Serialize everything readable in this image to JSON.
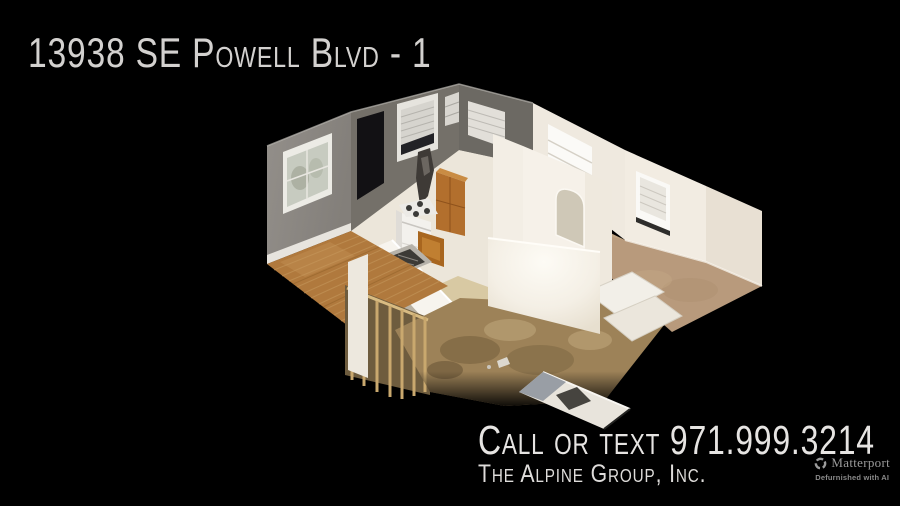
{
  "page": {
    "background_color": "#000000",
    "width": 900,
    "height": 506
  },
  "header": {
    "title": "13938 SE Powell Blvd - 1",
    "color": "#d3d1cf"
  },
  "contact": {
    "call_line": "Call or text 971.999.3214",
    "phone_number": "971.999.3214",
    "company_line": "The Alpine Group, Inc.",
    "color": "#e6e4e2"
  },
  "branding": {
    "logo_icon": "matterport-pinwheel-icon",
    "logo_text": "Matterport",
    "tagline": "Defurnished with AI",
    "color": "#9b9b9b"
  },
  "dollhouse": {
    "description": "3D cutaway dollhouse scan of a single-story apartment on black background",
    "rooms": [
      "living room",
      "kitchen",
      "hallway",
      "bathroom",
      "bedroom",
      "second bedroom"
    ],
    "features": [
      "gray living room walls",
      "large window with blinds",
      "dark doorway",
      "white range stove",
      "wood cabinets",
      "floor heat grate",
      "wood plank floor",
      "tan carpet floors",
      "exposed subfloor with framing studs",
      "bathtub shapes",
      "detached ramp fragment"
    ],
    "palette": {
      "gray_wall": "#8f8b86",
      "gray_wall_dark": "#747069",
      "white_wall": "#f3eee5",
      "wood_floor": "#b0793d",
      "carpet": "#b89a7c",
      "subfloor": "#9d8258",
      "cabinet_wood": "#b26f2d",
      "background": "#000000"
    }
  }
}
